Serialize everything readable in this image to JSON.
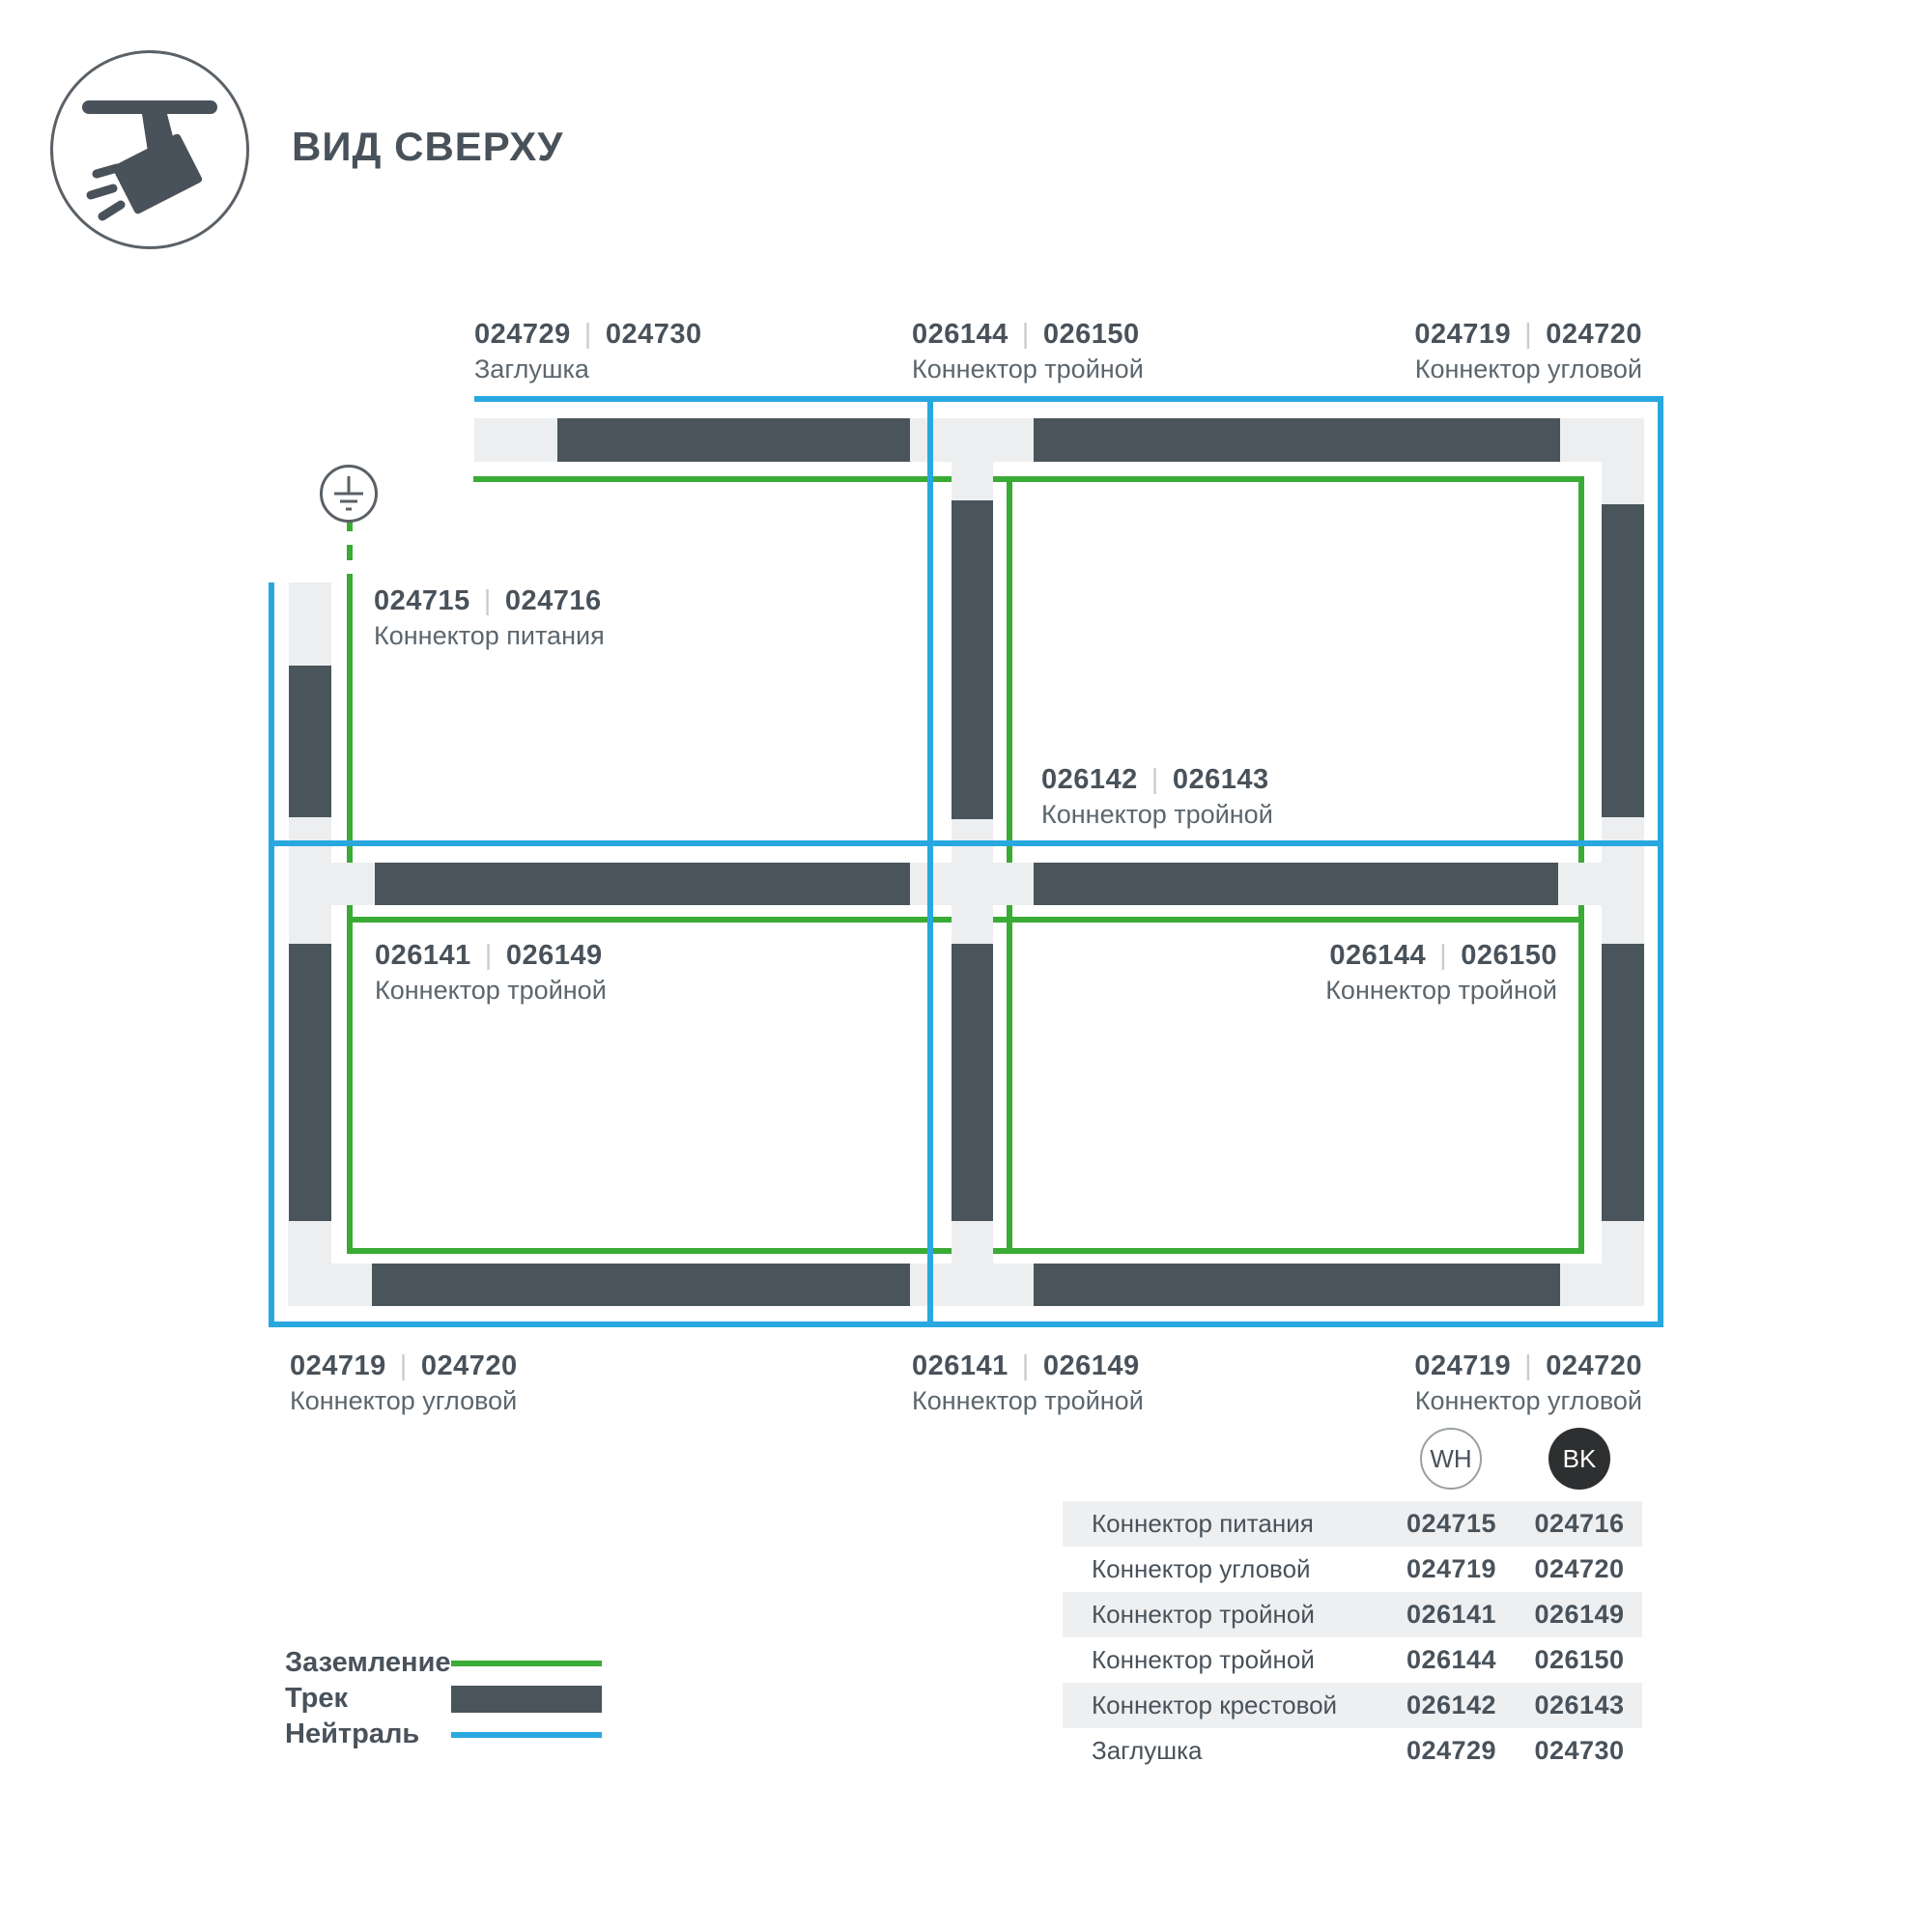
{
  "title": "ВИД СВЕРХУ",
  "sep": "|",
  "diagram_labels": {
    "top_cap": {
      "wh": "024729",
      "bk": "024730",
      "name": "Заглушка"
    },
    "top_triple": {
      "wh": "026144",
      "bk": "026150",
      "name": "Коннектор тройной"
    },
    "top_corner": {
      "wh": "024719",
      "bk": "024720",
      "name": "Коннектор угловой"
    },
    "power": {
      "wh": "024715",
      "bk": "024716",
      "name": "Коннектор питания"
    },
    "center_cross": {
      "wh": "026142",
      "bk": "026143",
      "name": "Коннектор тройной"
    },
    "mid_left_triple": {
      "wh": "026141",
      "bk": "026149",
      "name": "Коннектор тройной"
    },
    "mid_right_triple": {
      "wh": "026144",
      "bk": "026150",
      "name": "Коннектор тройной"
    },
    "bottom_corner_left": {
      "wh": "024719",
      "bk": "024720",
      "name": "Коннектор угловой"
    },
    "bottom_triple": {
      "wh": "026141",
      "bk": "026149",
      "name": "Коннектор тройной"
    },
    "bottom_corner_right": {
      "wh": "024719",
      "bk": "024720",
      "name": "Коннектор угловой"
    }
  },
  "badges": {
    "wh": "WH",
    "bk": "BK"
  },
  "parts_table": {
    "rows": [
      {
        "name": "Коннектор питания",
        "wh": "024715",
        "bk": "024716"
      },
      {
        "name": "Коннектор угловой",
        "wh": "024719",
        "bk": "024720"
      },
      {
        "name": "Коннектор тройной",
        "wh": "026141",
        "bk": "026149"
      },
      {
        "name": "Коннектор тройной",
        "wh": "026144",
        "bk": "026150"
      },
      {
        "name": "Коннектор крестовой",
        "wh": "026142",
        "bk": "026143"
      },
      {
        "name": "Заглушка",
        "wh": "024729",
        "bk": "024730"
      }
    ]
  },
  "legend": {
    "items": [
      {
        "label": "Заземление",
        "swatch": "green-line"
      },
      {
        "label": "Трек",
        "swatch": "dark-bar"
      },
      {
        "label": "Нейтраль",
        "swatch": "blue-line"
      }
    ]
  },
  "colors": {
    "ground_green": "#3aab35",
    "neutral_blue": "#29a8e0",
    "track_dark": "#4a545b",
    "connector_light": "#eceeef"
  }
}
